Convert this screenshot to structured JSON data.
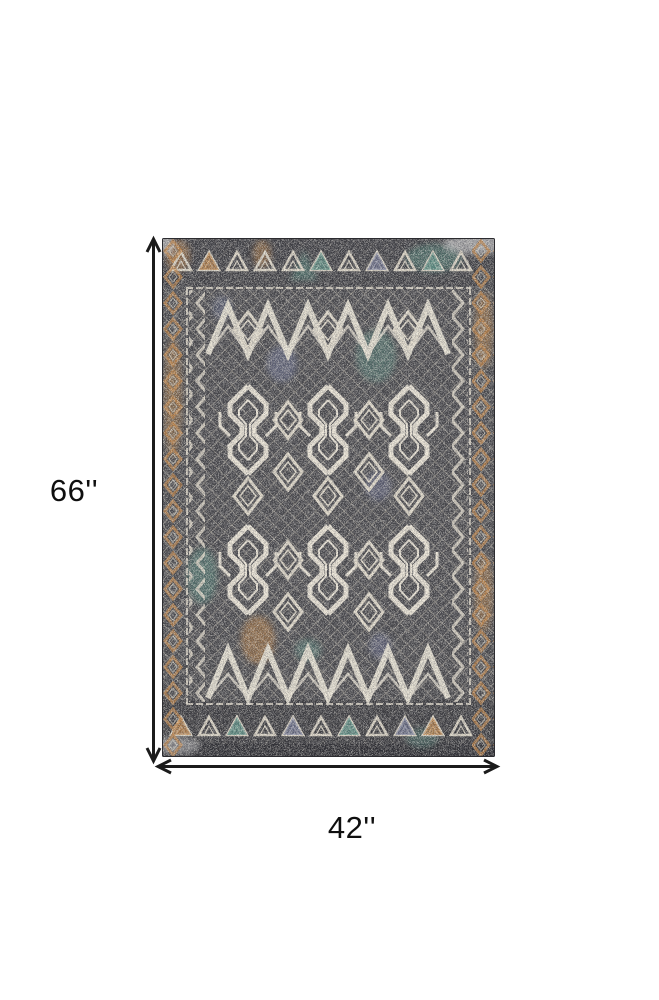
{
  "dimensions": {
    "height_label": "66''",
    "width_label": "42''"
  },
  "style": {
    "page_background": "#ffffff",
    "arrow_color": "#1b1b1b",
    "label_color": "#0f0f0f"
  },
  "rug": {
    "description": "Distressed tribal geometric area rug: charcoal gray ground, ivory diamond and hook medallion pattern, rust-orange diamond-chain side borders, triangle motif bands top and bottom, scattered teal, rust-orange and slate-blue accents",
    "palette": {
      "ground": "#4a4a4e",
      "border_band": "#3a3a40",
      "ivory": "#e7e1d3",
      "teal": "#5d9488",
      "rust_orange": "#c2874b",
      "slate_blue": "#767ca0",
      "edge": "#2c2c30"
    }
  }
}
